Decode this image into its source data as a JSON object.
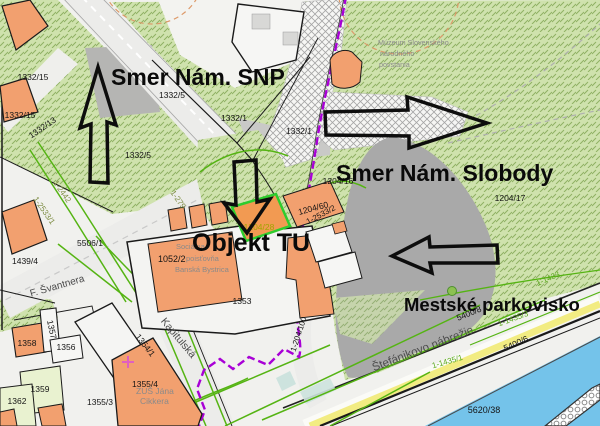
{
  "annotations": {
    "smer_snp": "Smer Nám. SNP",
    "smer_slobody": "Smer Nám. Slobody",
    "objekt_tu": "Objekt TU",
    "parkovisko": "Mestské parkovisko"
  },
  "streets": {
    "svantnera": "F. Švantnera",
    "kapitulska": "Kapitulská",
    "stefanikovo": "Štefánikovo nábrežie"
  },
  "places": {
    "muzeum1": "Múzeum Slovenského",
    "muzeum2": "národného",
    "muzeum3": "povstania",
    "soc1": "Sociálna",
    "soc2": "poisťovňa",
    "soc3": "Banská Bystrica",
    "zus1": "ZUŠ Jána",
    "zus2": "Cikkera"
  },
  "parcels": {
    "a1332_15a": "1332/15",
    "a1332_15b": "1332/15",
    "a1332_13": "1332/13",
    "a1332_5a": "1332/5",
    "a1332_5b": "1332/5",
    "a1332_1a": "1332/1",
    "a1332_1b": "1332/1",
    "a1204_16": "1204/16",
    "a1204_17": "1204/17",
    "a1204_60": "1204/60",
    "a1204_28": "1204/28",
    "a2533_2": "1-2533/2",
    "a2533_1": "1-2533/1",
    "a2442": "1-2442",
    "a279": "1-279",
    "a5506_1": "5506/1",
    "a1439_4": "1439/4",
    "a1052_2": "1052/2",
    "a1353": "1353",
    "a1354_1": "1354/1",
    "a1355_4": "1355/4",
    "a1355_3": "1355/3",
    "a1358": "1358",
    "a1357": "1357",
    "a1356": "1356",
    "a1359": "1359",
    "a1362": "1362",
    "a5400_8": "5400/8",
    "a5400_6": "5400/6",
    "a5620_38": "5620/38",
    "a204_100": "1-204/100",
    "a1433": "1-1433",
    "a1435_1": "1-1435/1",
    "a1435_3": "1-1435/3"
  },
  "colors": {
    "highlight_parcel": "#f29a52",
    "highlight_border": "#2ecc2e",
    "boundary_purple": "#a800d6",
    "utility_green": "#55b413",
    "water": "#74c3ea",
    "parking_gray": "#a9a9a9",
    "building_orange": "#f2a06f",
    "road_stripe_yellow": "#f2ec82",
    "vegetation_green": "#cfe2ad"
  }
}
